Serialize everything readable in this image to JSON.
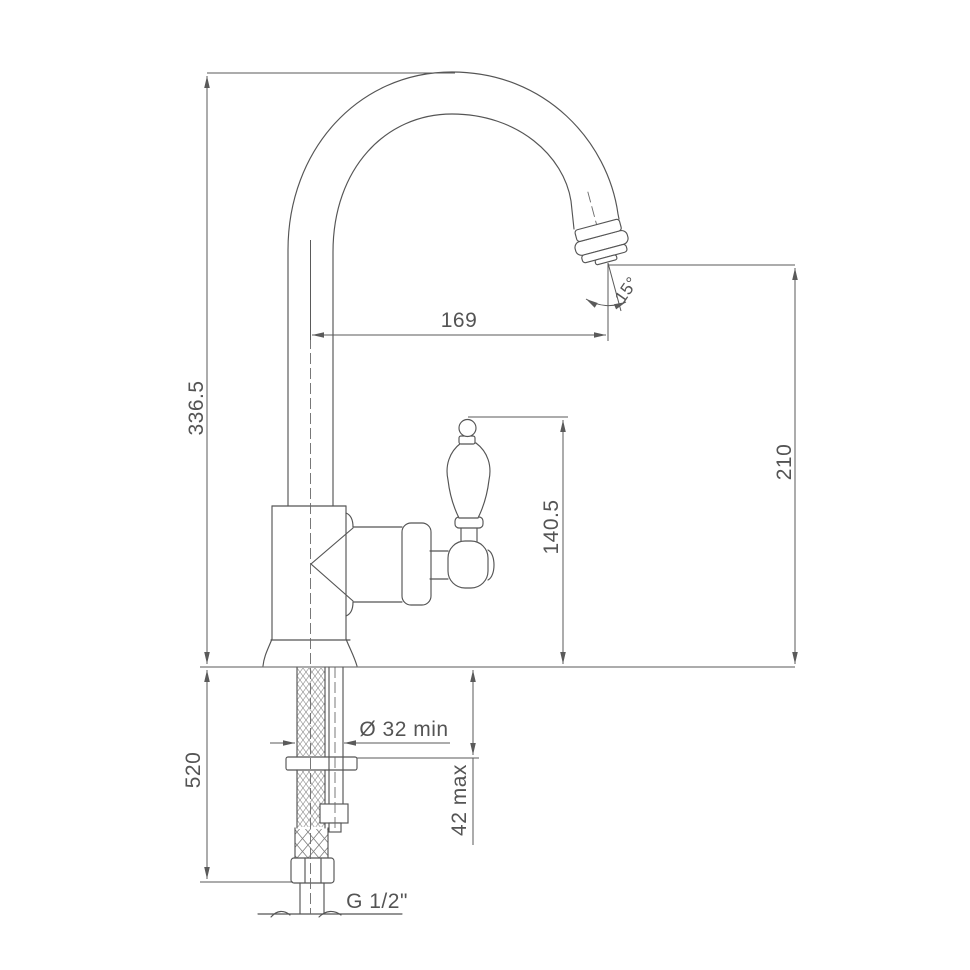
{
  "drawing": {
    "type": "faucet-installation-dimension-drawing",
    "background": "#ffffff",
    "line_color": "#555555",
    "text_color": "#545454",
    "dimensions": {
      "overall_height": "336.5",
      "spout_reach": "169",
      "spout_angle": "15°",
      "deck_to_handle_top": "140.5",
      "deck_to_spout_outlet": "210",
      "below_deck_length": "520",
      "mounting_hole": "Ø 32 min",
      "deck_thickness": "42 max",
      "connection_thread": "G 1/2\""
    }
  }
}
